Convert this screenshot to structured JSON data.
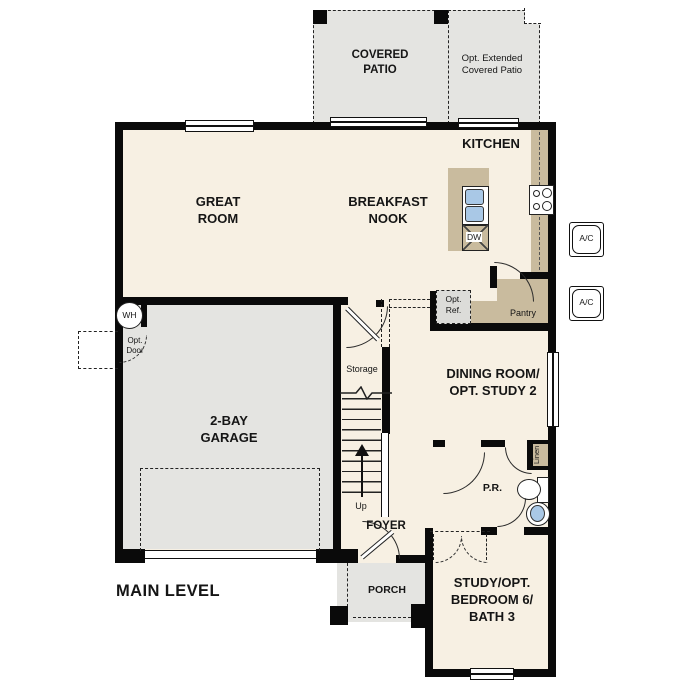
{
  "colors": {
    "floor_cream": "#f7f0e3",
    "floor_gray": "#e4e4e1",
    "cabinet_tan": "#c9bb9e",
    "fixture_blue": "#a9c8e6",
    "wall_black": "#0a0a0a"
  },
  "labels": {
    "covered_patio": "COVERED\nPATIO",
    "opt_extended_patio": "Opt. Extended\nCovered Patio",
    "kitchen": "KITCHEN",
    "great_room": "GREAT\nROOM",
    "breakfast_nook": "BREAKFAST\nNOOK",
    "garage": "2-BAY\nGARAGE",
    "dining_room": "DINING ROOM/\nOPT. STUDY 2",
    "study": "STUDY/OPT.\nBEDROOM 6/\nBATH 3",
    "foyer": "FOYER",
    "porch": "PORCH",
    "storage": "Storage",
    "up": "Up",
    "pantry": "Pantry",
    "linen": "Linen",
    "powder_room": "P.R.",
    "water_heater": "WH",
    "opt_door": "Opt.\nDoor",
    "opt_ref": "Opt.\nRef.",
    "dishwasher": "DW",
    "ac_top": "A/C",
    "ac_bottom": "A/C",
    "main_level": "MAIN LEVEL"
  }
}
